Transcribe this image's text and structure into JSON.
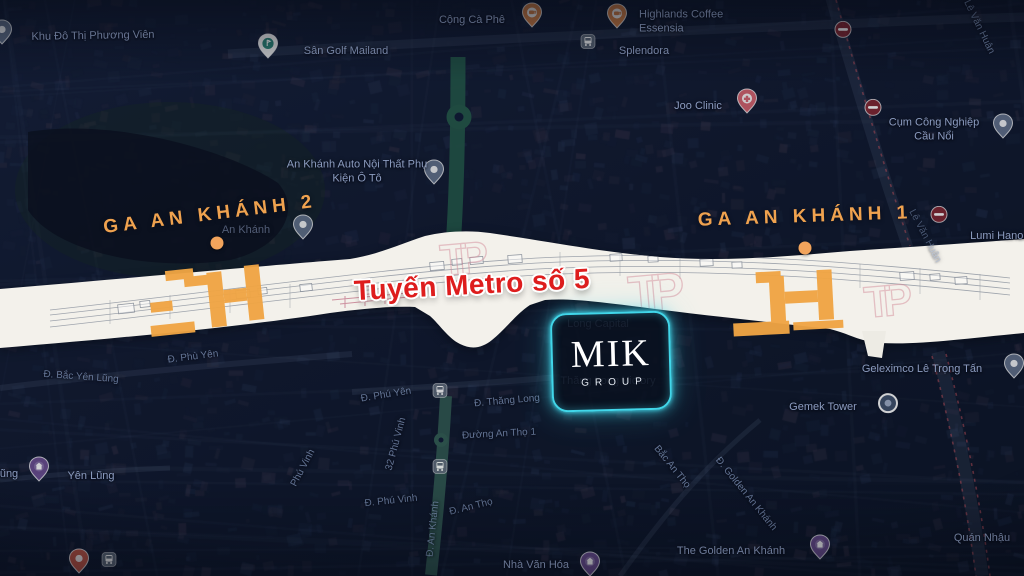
{
  "overlay": {
    "station_left": "GA AN KHÁNH 2",
    "station_right": "GA AN KHÁNH 1",
    "metro_line": "Tuyến Metro số 5",
    "logo": {
      "brand": "MIK",
      "sub": "GROUP"
    },
    "colors": {
      "station_orange": "#EFA24F",
      "metro_red": "#DE1D1D",
      "logo_glow": "#41D6E9",
      "corridor_white": "#F3F1EB",
      "station_footprint": "#F0A544"
    }
  },
  "map": {
    "labels": [
      {
        "text": "Khu Đô Thị Phương Viên",
        "x": 93,
        "y": 36,
        "rot": -1,
        "kind": "place"
      },
      {
        "text": "Sân Golf Mailand",
        "x": 346,
        "y": 51,
        "kind": "place"
      },
      {
        "text": "Cộng Cà Phê",
        "x": 472,
        "y": 20,
        "kind": "place"
      },
      {
        "text": "Highlands Coffee Essensia",
        "x": 700,
        "y": 22,
        "w": 122,
        "align": "left",
        "kind": "place"
      },
      {
        "text": "Splendora",
        "x": 644,
        "y": 51,
        "kind": "place"
      },
      {
        "text": "Joo Clinic",
        "x": 698,
        "y": 106,
        "kind": "place"
      },
      {
        "text": "Cụm Công Nghiệp Cầu Nổi",
        "x": 934,
        "y": 130,
        "w": 112,
        "kind": "place"
      },
      {
        "text": "Lê Văn Huân",
        "x": 979,
        "y": 27,
        "rot": 64,
        "kind": "street"
      },
      {
        "text": "Lê Văn Huân",
        "x": 925,
        "y": 236,
        "rot": 62,
        "kind": "street dim"
      },
      {
        "text": "Lumi Hanoi",
        "x": 998,
        "y": 236,
        "kind": "place"
      },
      {
        "text": "An Khánh Auto Nội Thất Phụ Kiện Ô Tô",
        "x": 357,
        "y": 172,
        "w": 142,
        "kind": "place"
      },
      {
        "text": "An Khánh",
        "x": 246,
        "y": 230,
        "kind": "place dim"
      },
      {
        "text": "ũng",
        "x": 9,
        "y": 474,
        "kind": "place"
      },
      {
        "text": "Yên Lũng",
        "x": 91,
        "y": 476,
        "kind": "place"
      },
      {
        "text": "Đ. Bắc Yên Lũng",
        "x": 81,
        "y": 377,
        "rot": 4,
        "kind": "street"
      },
      {
        "text": "Đ. Phù Yên",
        "x": 193,
        "y": 357,
        "rot": -7,
        "kind": "street"
      },
      {
        "text": "Đ. Phú Yên",
        "x": 386,
        "y": 395,
        "rot": -9,
        "kind": "street"
      },
      {
        "text": "Đ. Thăng Long",
        "x": 507,
        "y": 401,
        "rot": -5,
        "kind": "street"
      },
      {
        "text": "Đường An Thọ 1",
        "x": 499,
        "y": 434,
        "rot": -3,
        "kind": "street"
      },
      {
        "text": "32 Phú Vinh",
        "x": 396,
        "y": 444,
        "rot": -75,
        "kind": "street"
      },
      {
        "text": "Phú Vinh",
        "x": 303,
        "y": 468,
        "rot": -62,
        "kind": "street"
      },
      {
        "text": "Đ. Phú Vinh",
        "x": 391,
        "y": 501,
        "rot": -6,
        "kind": "street"
      },
      {
        "text": "Đ. An Khánh",
        "x": 433,
        "y": 529,
        "rot": -84,
        "kind": "street"
      },
      {
        "text": "Đ. An Thọ",
        "x": 471,
        "y": 507,
        "rot": -14,
        "kind": "street"
      },
      {
        "text": "Nhà Văn Hóa",
        "x": 536,
        "y": 565,
        "kind": "place"
      },
      {
        "text": "Bắc An Thọ",
        "x": 672,
        "y": 467,
        "rot": 51,
        "kind": "street"
      },
      {
        "text": "Đ. Golden An Khánh",
        "x": 746,
        "y": 494,
        "rot": 51,
        "kind": "street"
      },
      {
        "text": "The Golden An Khánh",
        "x": 731,
        "y": 551,
        "kind": "place"
      },
      {
        "text": "Geleximco Lê Trọng Tấn",
        "x": 922,
        "y": 369,
        "kind": "place"
      },
      {
        "text": "Gemek Tower",
        "x": 823,
        "y": 407,
        "kind": "place"
      },
      {
        "text": "Quán Nhậu",
        "x": 982,
        "y": 538,
        "kind": "place"
      },
      {
        "text": "Long Capital",
        "x": 598,
        "y": 324,
        "kind": "place dim"
      },
      {
        "text": "Thăng Long Victory",
        "x": 608,
        "y": 381,
        "kind": "place dim"
      }
    ],
    "icons": [
      {
        "type": "pin-blue",
        "x": 2,
        "y": 36
      },
      {
        "type": "pin-golf",
        "x": 268,
        "y": 50
      },
      {
        "type": "pin-coffee",
        "x": 532,
        "y": 19
      },
      {
        "type": "pin-coffee",
        "x": 617,
        "y": 20
      },
      {
        "type": "bus",
        "x": 588,
        "y": 45
      },
      {
        "type": "pin-medical",
        "x": 747,
        "y": 105
      },
      {
        "type": "pin-blue",
        "x": 1003,
        "y": 130
      },
      {
        "type": "pin-blue",
        "x": 434,
        "y": 176
      },
      {
        "type": "pin-blue",
        "x": 303,
        "y": 231
      },
      {
        "type": "no-entry",
        "x": 843,
        "y": 33
      },
      {
        "type": "no-entry",
        "x": 873,
        "y": 111
      },
      {
        "type": "no-entry",
        "x": 939,
        "y": 218
      },
      {
        "type": "pin-purple",
        "x": 39,
        "y": 473
      },
      {
        "type": "pin-purple",
        "x": 590,
        "y": 568
      },
      {
        "type": "pin-purple",
        "x": 820,
        "y": 551
      },
      {
        "type": "pin-circle",
        "x": 888,
        "y": 407
      },
      {
        "type": "pin-blue",
        "x": 1014,
        "y": 370
      },
      {
        "type": "pin-red",
        "x": 79,
        "y": 565
      },
      {
        "type": "bus",
        "x": 109,
        "y": 563
      },
      {
        "type": "bus",
        "x": 440,
        "y": 394
      },
      {
        "type": "bus",
        "x": 440,
        "y": 470
      }
    ],
    "station_dots": [
      {
        "x": 217,
        "y": 243
      },
      {
        "x": 805,
        "y": 248
      }
    ]
  }
}
